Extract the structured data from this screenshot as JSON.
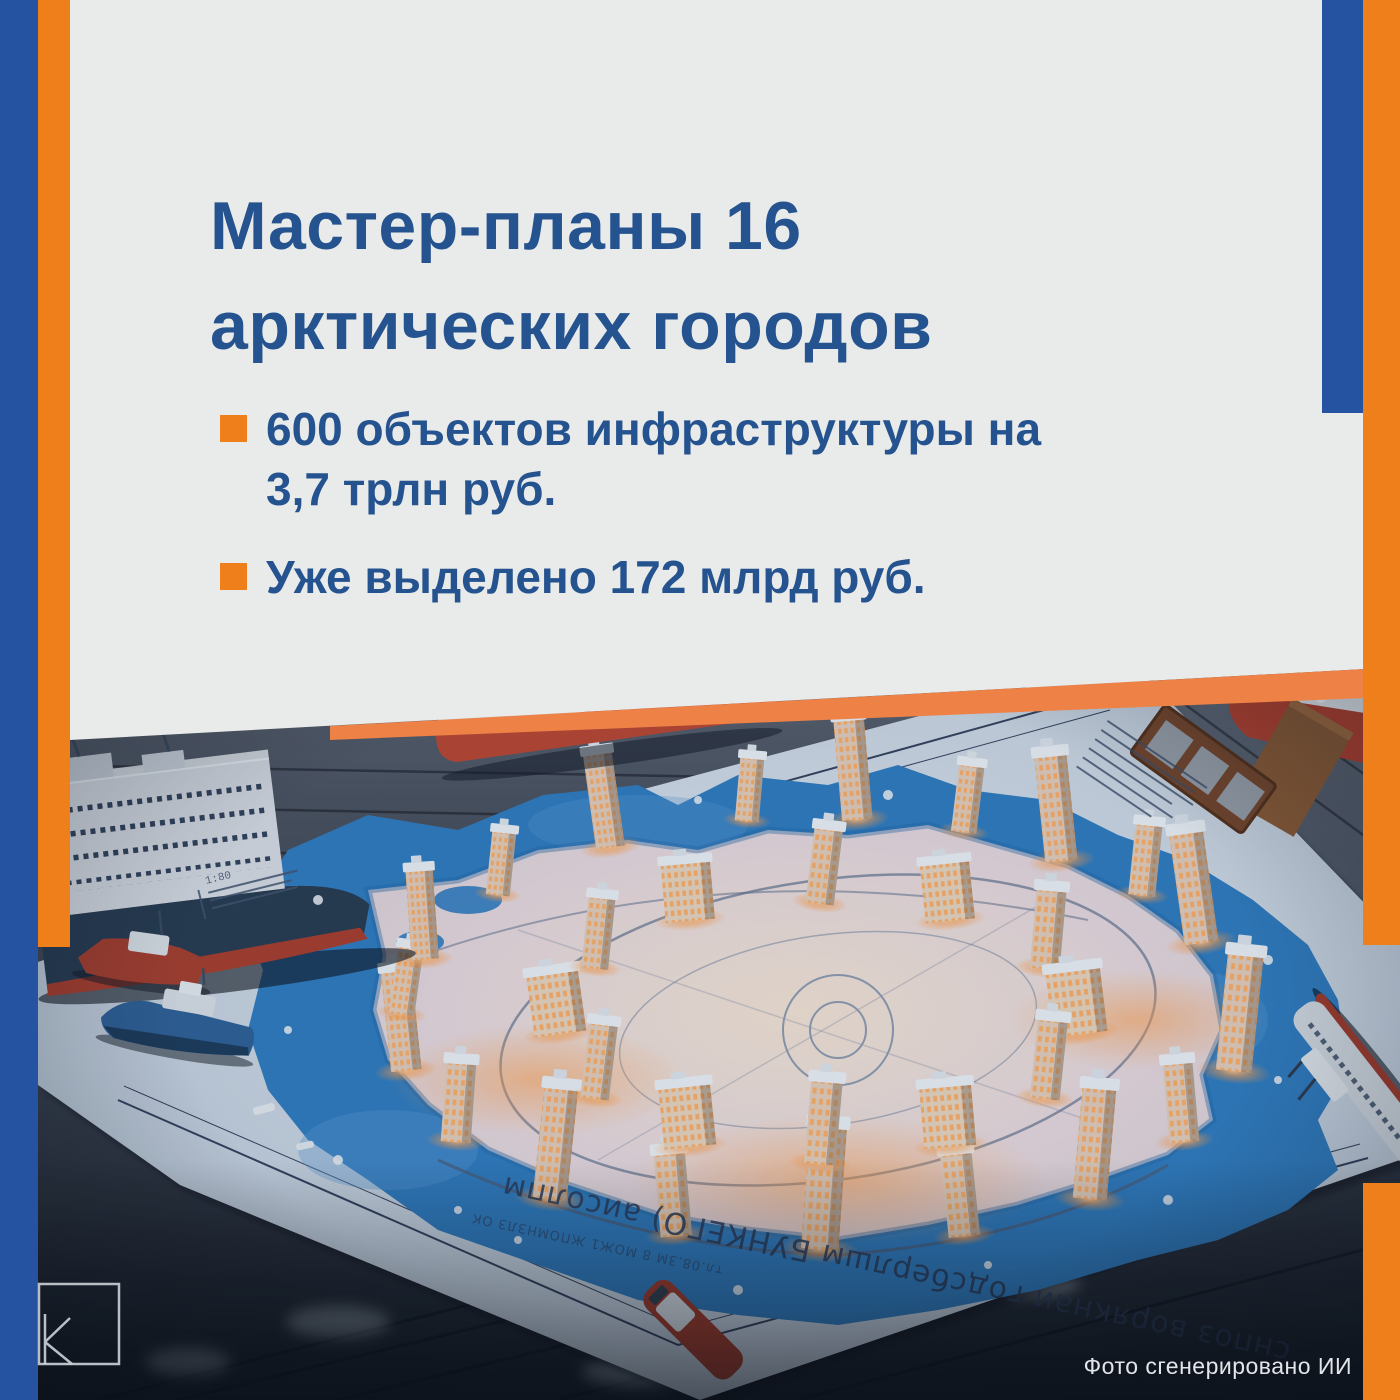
{
  "card": {
    "title": {
      "line1": "Мастер-планы 16",
      "line2": "арктических городов"
    },
    "bullets": [
      {
        "line1": "600 объектов инфраструктуры на",
        "line2": "3,7 трлн руб."
      },
      {
        "line1": "Уже выделено 172 млрд руб.",
        "line2": ""
      }
    ]
  },
  "photo": {
    "watermark": "Фото сгенерировано ИИ",
    "map_caption": "снпоз ворякнаи годсберлшм БУНКЕГО) аисолпм",
    "map_caption_small": "тл.08.3М 8 МОЖ1 ЖПОМНЗЛЗ ОК",
    "map_scale": "1:80"
  },
  "logo": {
    "letter": "К"
  },
  "colors": {
    "blue": "#2553a2",
    "orange": "#ef7f1b",
    "band_orange": "#ee8145",
    "text_blue": "#25538f",
    "card_bg": "#e9eaea"
  }
}
